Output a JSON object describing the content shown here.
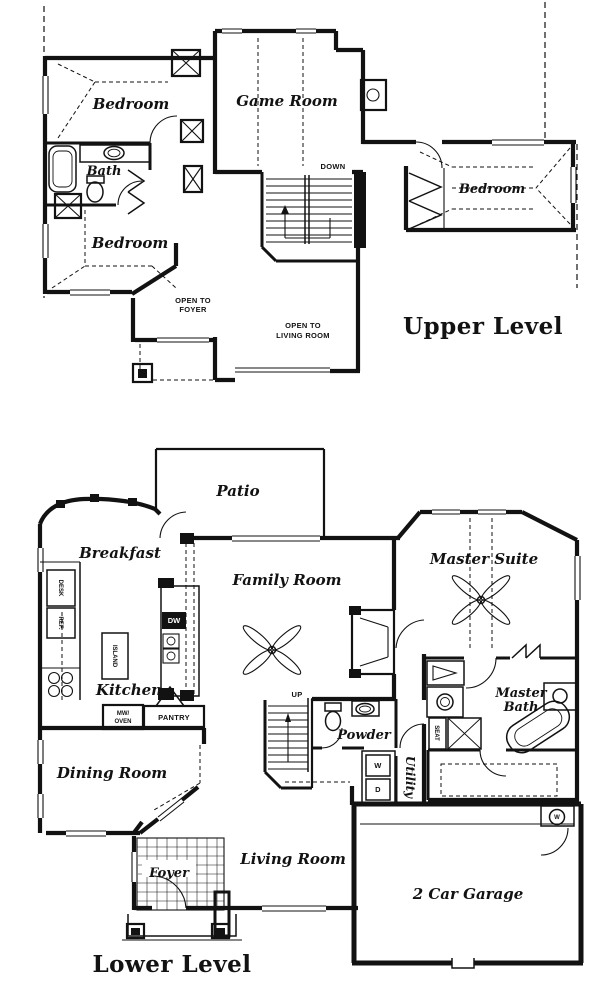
{
  "colors": {
    "ink": "#121212",
    "paper": "#ffffff"
  },
  "upper": {
    "title": "Upper Level",
    "rooms": {
      "bedroom_top_left": "Bedroom",
      "game_room": "Game Room",
      "bath": "Bath",
      "bedroom_left": "Bedroom",
      "bedroom_right": "Bedroom"
    },
    "labels": {
      "down": "DOWN",
      "open_to_foyer_line1": "OPEN TO",
      "open_to_foyer_line2": "FOYER",
      "open_to_living_line1": "OPEN TO",
      "open_to_living_line2": "LIVING ROOM"
    }
  },
  "lower": {
    "title": "Lower Level",
    "rooms": {
      "patio": "Patio",
      "breakfast": "Breakfast",
      "family_room": "Family Room",
      "master_suite": "Master Suite",
      "kitchen": "Kitchen",
      "dining_room": "Dining Room",
      "powder": "Powder",
      "utility": "Utility",
      "master_bath_line1": "Master",
      "master_bath_line2": "Bath",
      "foyer": "Foyer",
      "living_room": "Living Room",
      "garage": "2 Car Garage"
    },
    "labels": {
      "desk": "DESK",
      "ref": "REF.",
      "island": "ISLAND",
      "dw": "DW",
      "mw_oven_line1": "MW/",
      "mw_oven_line2": "OVEN",
      "pantry": "PANTRY",
      "up": "UP",
      "washer": "W",
      "dryer": "D",
      "seat": "SEAT",
      "water_heater": "W"
    }
  }
}
